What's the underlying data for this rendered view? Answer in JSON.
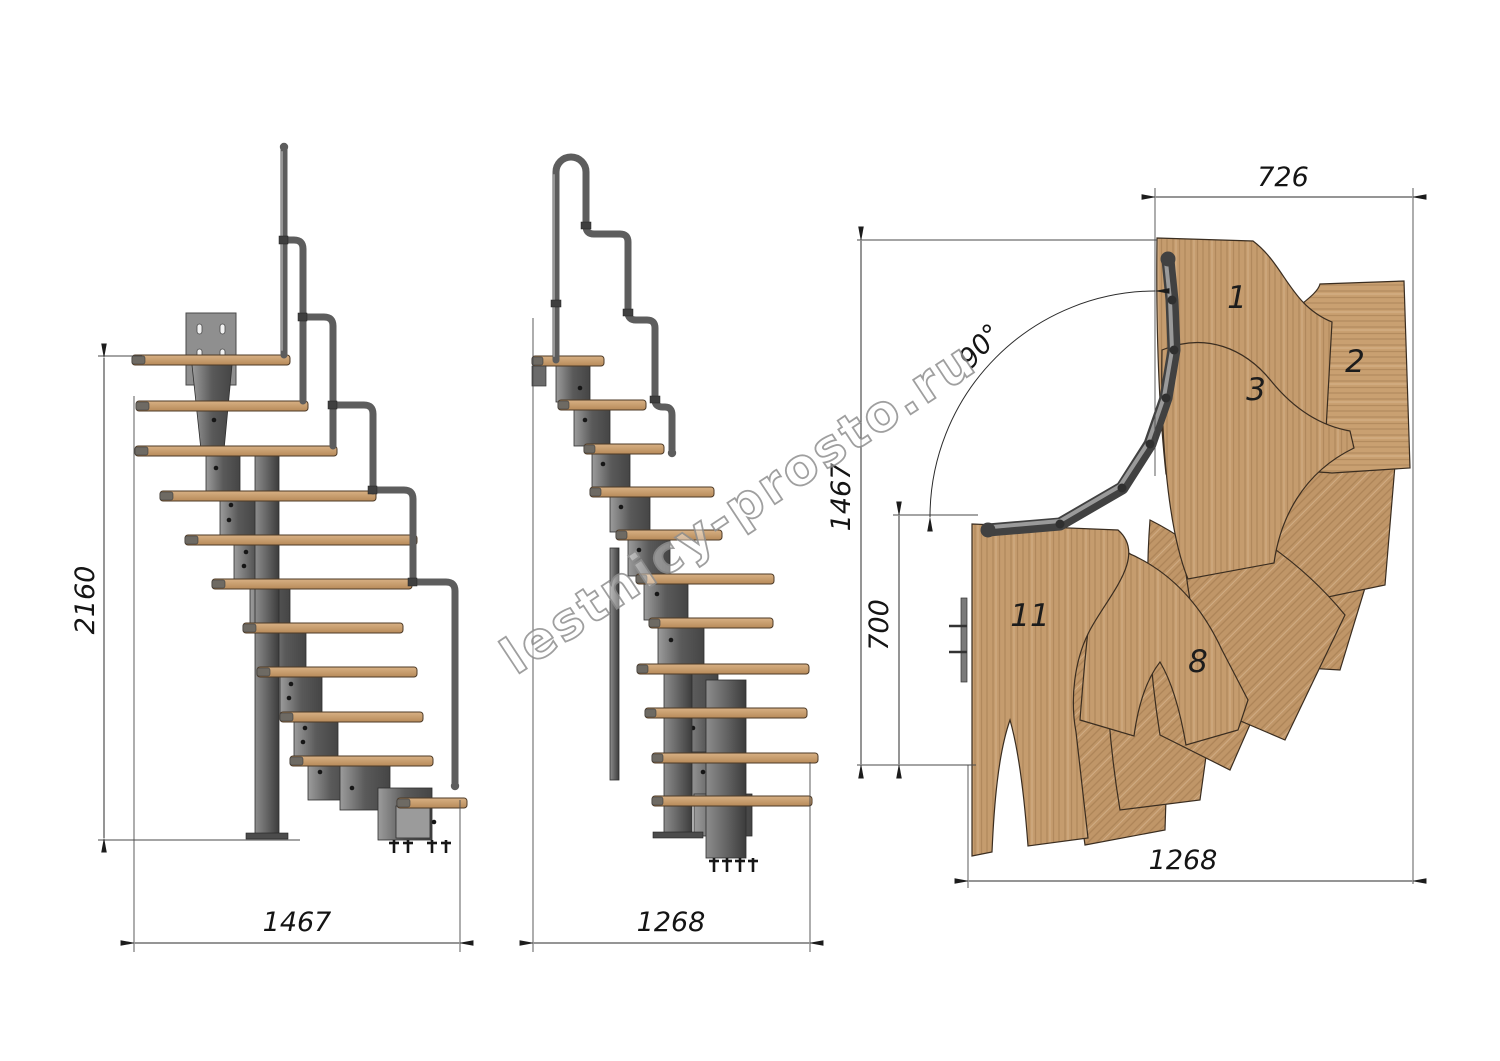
{
  "watermark": {
    "text": "lestnicy-prosto.ru"
  },
  "dimensions": {
    "side_view": {
      "height_total": "2160",
      "width_total": "1467"
    },
    "front_view": {
      "width_total": "1268"
    },
    "plan_view": {
      "top_width": "726",
      "left_height": "1467",
      "left_lower_height": "700",
      "bottom_width": "1268",
      "turn_angle": "90°"
    }
  },
  "plan_step_labels": {
    "step1": "1",
    "step2": "2",
    "step3": "3",
    "step8": "8",
    "step11": "11"
  },
  "colors": {
    "wood": "#c59c6e",
    "wood_dark": "#a8835a",
    "metal": "#6e6e6e",
    "metal_dark": "#454545",
    "dimension_line": "#2b2b2b",
    "text": "#141414",
    "watermark": "#8f8f8f",
    "background": "#ffffff"
  }
}
